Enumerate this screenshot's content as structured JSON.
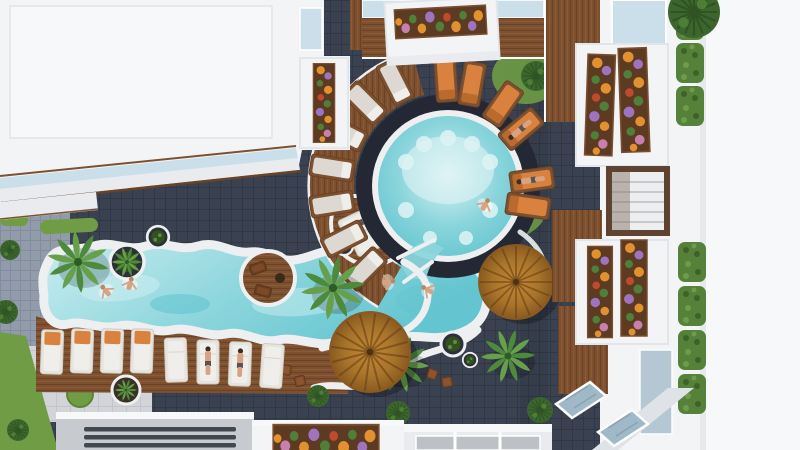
{
  "meta": {
    "label": "Aerial 3D architectural rendering of a resort pool courtyard",
    "style": "photorealistic top-down render",
    "time_of_day": "daytime"
  },
  "palette": {
    "tile_dark": "#3a4150",
    "tile_line": "#313845",
    "tile_mid": "#929baa",
    "tile_mid_line": "#828c9c",
    "pave": "#d2d4d8",
    "pave_line": "#c2c5ca",
    "white1": "#f3f4f6",
    "white2": "#e9ebee",
    "white_bright": "#f7f8f9",
    "edge": "#e2e6ea",
    "glass": "#cadfe9",
    "glass_dark": "#9fb9c8",
    "wood": "#7d5130",
    "wood_dark": "#6a4226",
    "wood_light": "#8f5d38",
    "ring_dark": "#232834",
    "coping": "#edeff0",
    "water_pale": "#dff4f5",
    "water_light": "#c9edf0",
    "water_main": "#8bd5dc",
    "water_deep": "#64c5d0",
    "umb_hi": "#c08433",
    "umb_mid": "#a8742a",
    "umb_lo": "#8a5a20",
    "umb_dark": "#5f3d14",
    "palm1": "#4e8a3c",
    "palm2": "#66a04a",
    "palm_dark": "#2f5c26",
    "grass": "#6f9c44",
    "bush_dark": "#3c662e",
    "hedge": "#55813a",
    "cushion": "#ddd9d2",
    "lounger_white": "#e6e4df",
    "towel": "#d9813e",
    "skin": "#d9a383",
    "hair": "#3a2e26",
    "flower_orange": "#e2912f",
    "flower_purple": "#9d74bd",
    "flower_pink": "#c77fae",
    "flower_red": "#bf4a2c",
    "leaf": "#4f7f38",
    "seat_brown": "#7b4a2a",
    "sofa": "#6b3f22",
    "roof_gray": "#c7cacf",
    "roof_inner": "#bdc1c6",
    "vent": "#41464f"
  },
  "scene": {
    "setting": {
      "label": "Resort courtyard seen from directly above, enclosed by white low-rise buildings"
    },
    "pools": {
      "round": {
        "label": "Circular pool with dark tile ring, white coping and pale underwater seats",
        "swimmers": 1,
        "underwater_seats": 9
      },
      "lagoon": {
        "label": "Free-form lagoon pool with wavy white coping",
        "swimmers": 4,
        "islands": 2
      }
    },
    "decks": {
      "curved": {
        "label": "Curved timber sun deck hugging the round pool",
        "loungers": 7
      },
      "lagoon_deck": {
        "label": "Timber deck with two rows of white sun loungers",
        "loungers": 8
      },
      "peninsula": {
        "label": "Deck peninsula with loungers and a round planter",
        "loungers": 2
      },
      "lounge_island": {
        "label": "Round timber island with two sofas and a table",
        "sofas": 2
      }
    },
    "furniture": {
      "orange_loungers": 6,
      "white_loungers": 8,
      "deck_loungers": 9,
      "thatched_umbrellas": 2,
      "cube_seats": 6,
      "sofas": 2
    },
    "vegetation": {
      "palm_trees": 5,
      "round_bushes": 8,
      "hedge_segments": 7,
      "flower_planter_boxes": 7,
      "round_planters": 6,
      "grass_circles": 2,
      "flower_colors": [
        "orange",
        "purple",
        "pink",
        "red",
        "green"
      ]
    },
    "buildings": {
      "left": {
        "label": "White flat-roof building with glass trim, balcony flower boxes"
      },
      "right": {
        "label": "White building facade with balconies, flower boxes, hedge strips, louvered window and angled skylights"
      },
      "bottom": {
        "label": "Lower roofs: gray vented roof, roof planter full of flowers, white partitioned roof"
      },
      "top": {
        "label": "Glass strip, timber deck band and balcony flower box"
      }
    },
    "people": {
      "total": 11,
      "swimming": 5,
      "sunbathing": 4,
      "walking": 2
    }
  }
}
